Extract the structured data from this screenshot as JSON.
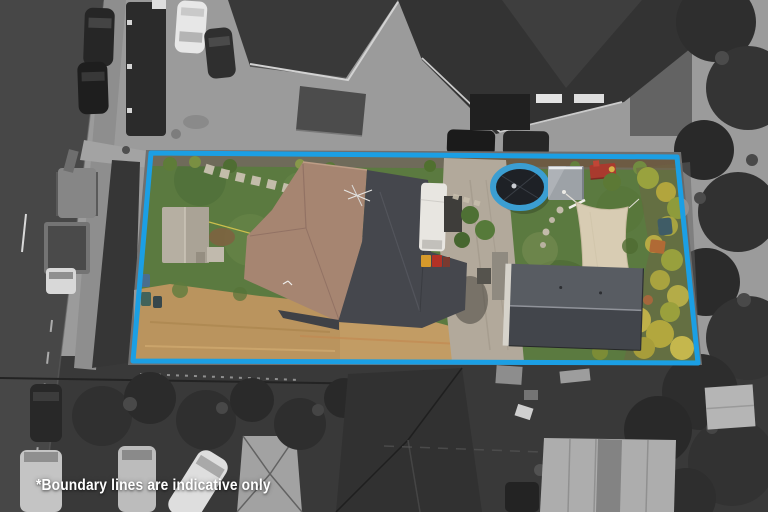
{
  "overlay": {
    "disclaimer_text": "*Boundary lines are indicative only",
    "text_color": "#ffffff"
  },
  "boundary": {
    "stroke_color": "#1B9FE4",
    "stroke_width": 5,
    "corners_px": "151,153 677,157 698,363 133,361",
    "inside_region": "full color",
    "outside_region": "grayscale"
  },
  "scene": {
    "objects": [
      "road",
      "footpath",
      "parked-cars",
      "excavator",
      "truck",
      "neighbour-houses",
      "main-house",
      "garden-shed",
      "trampoline",
      "small-shed",
      "play-structure",
      "shade-sail",
      "outbuilding",
      "driveway",
      "lawn",
      "bare-dirt",
      "hedges",
      "trees",
      "vans",
      "marquee-tent"
    ]
  }
}
